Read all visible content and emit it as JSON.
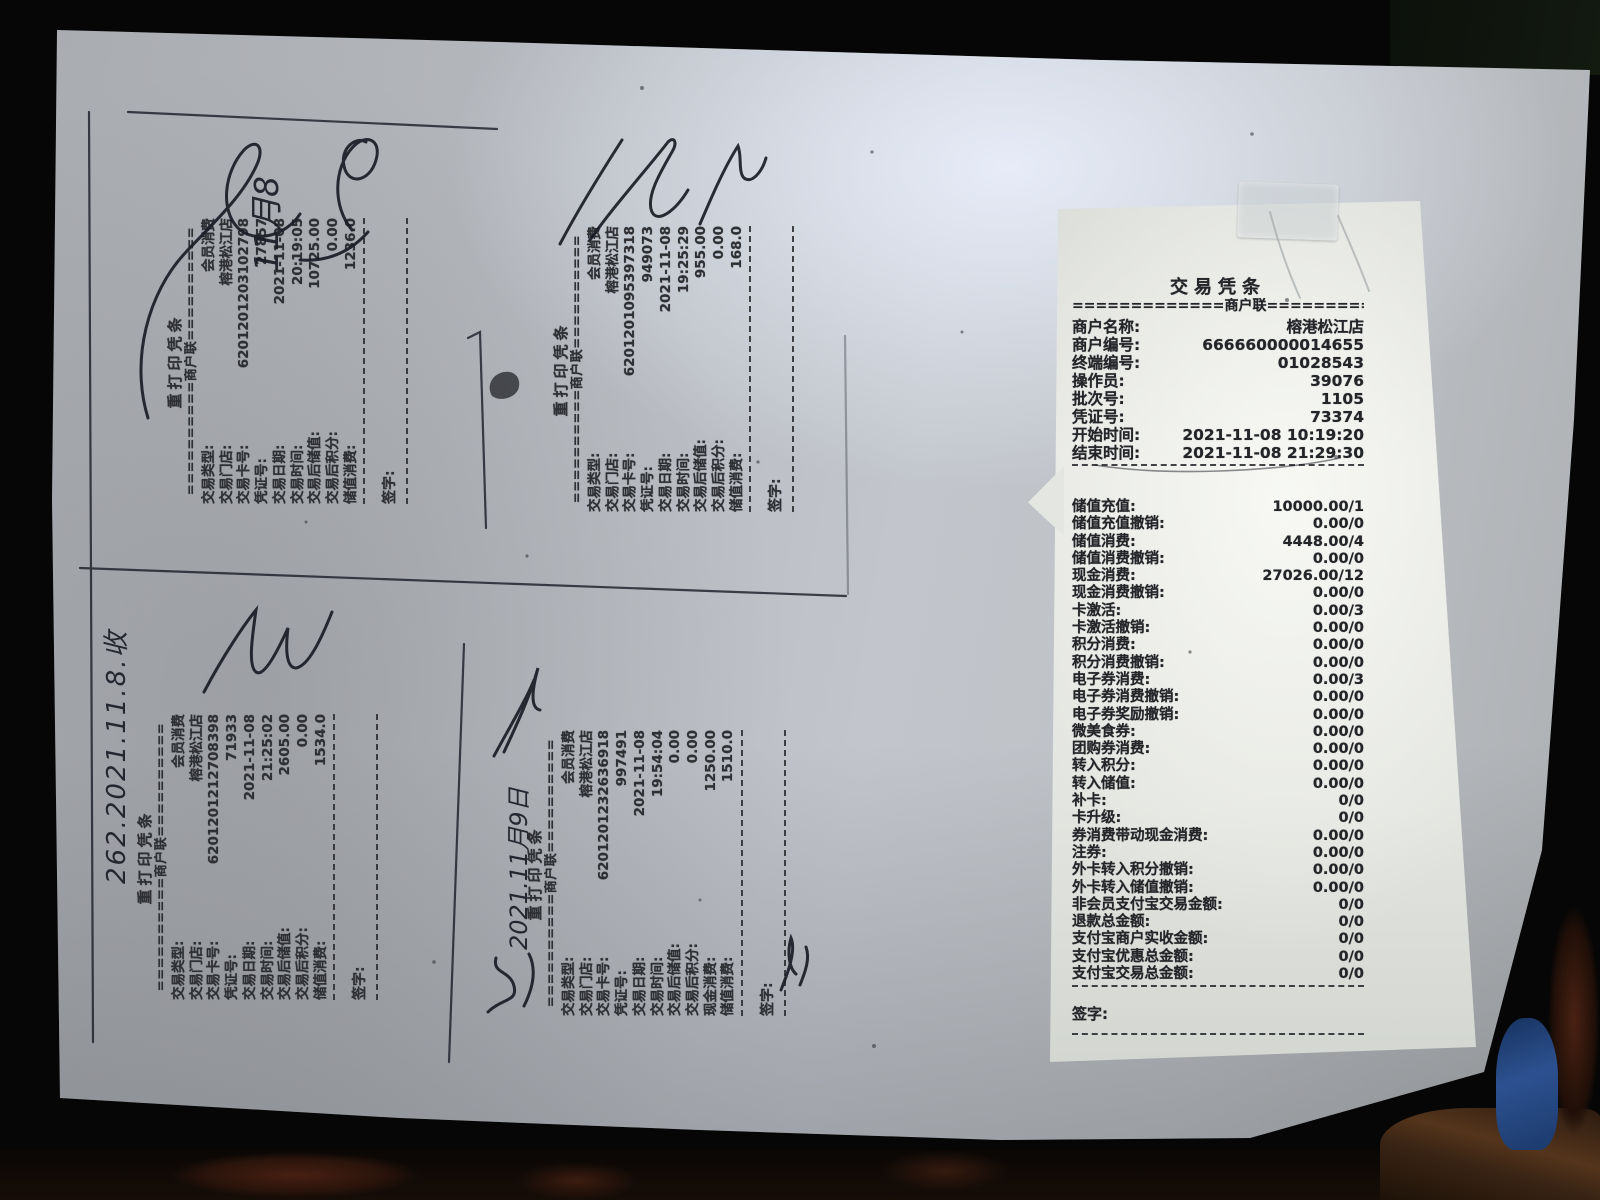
{
  "palette": {
    "background": "#060606",
    "paper": "#b3b6bb",
    "paper_highlight": "#dde2ec",
    "receipt_paper": "#e6e8e4",
    "print_ink": "#2e3034",
    "pen_ink": "#1a1c26",
    "tape": "#cacfd2",
    "blue_object": "#2d5190",
    "table_brown": "#3a2414"
  },
  "reprint_slips": [
    {
      "title": "重打印凭条",
      "copy_line": "==========商户联==========",
      "rows": [
        {
          "label": "交易类型:",
          "value": "会员消费"
        },
        {
          "label": "交易门店:",
          "value": "榕港松江店"
        },
        {
          "label": "交易卡号:",
          "value": "6201201203102798"
        },
        {
          "label": "凭证号:",
          "value": "27857"
        },
        {
          "label": "交易日期:",
          "value": "2021-11-08"
        },
        {
          "label": "交易时间:",
          "value": "20:19:05"
        },
        {
          "label": "交易后储值:",
          "value": "10725.00"
        },
        {
          "label": "交易后积分:",
          "value": "0.00"
        },
        {
          "label": "储值消费:",
          "value": "1236.0"
        }
      ],
      "sign_label": "签字:"
    },
    {
      "title": "重打印凭条",
      "copy_line": "==========商户联==========",
      "rows": [
        {
          "label": "交易类型:",
          "value": "会员消费"
        },
        {
          "label": "交易门店:",
          "value": "榕港松江店"
        },
        {
          "label": "交易卡号:",
          "value": "6201201095397318"
        },
        {
          "label": "凭证号:",
          "value": "949073"
        },
        {
          "label": "交易日期:",
          "value": "2021-11-08"
        },
        {
          "label": "交易时间:",
          "value": "19:25:29"
        },
        {
          "label": "交易后储值:",
          "value": "955.00"
        },
        {
          "label": "交易后积分:",
          "value": "0.00"
        },
        {
          "label": "储值消费:",
          "value": "168.0"
        }
      ],
      "sign_label": "签字:"
    },
    {
      "title": "重打印凭条",
      "copy_line": "==========商户联==========",
      "rows": [
        {
          "label": "交易类型:",
          "value": "会员消费"
        },
        {
          "label": "交易门店:",
          "value": "榕港松江店"
        },
        {
          "label": "交易卡号:",
          "value": "6201201212708398"
        },
        {
          "label": "凭证号:",
          "value": "71933"
        },
        {
          "label": "交易日期:",
          "value": "2021-11-08"
        },
        {
          "label": "交易时间:",
          "value": "21:25:02"
        },
        {
          "label": "交易后储值:",
          "value": "2605.00"
        },
        {
          "label": "交易后积分:",
          "value": "0.00"
        },
        {
          "label": "储值消费:",
          "value": "1534.0"
        }
      ],
      "sign_label": "签字:"
    },
    {
      "title": "重打印凭条",
      "copy_line": "==========商户联==========",
      "rows": [
        {
          "label": "交易类型:",
          "value": "会员消费"
        },
        {
          "label": "交易门店:",
          "value": "榕港松江店"
        },
        {
          "label": "交易卡号:",
          "value": "6201201232636918"
        },
        {
          "label": "凭证号:",
          "value": "997491"
        },
        {
          "label": "交易日期:",
          "value": "2021-11-08"
        },
        {
          "label": "交易时间:",
          "value": "19:54:04"
        },
        {
          "label": "交易后储值:",
          "value": "0.00"
        },
        {
          "label": "交易后积分:",
          "value": "0.00"
        },
        {
          "label": "现金消费:",
          "value": "1250.00"
        },
        {
          "label": "储值消费:",
          "value": "1510.0"
        }
      ],
      "sign_label": "签字:"
    }
  ],
  "summary_slip": {
    "title": "交易凭条",
    "copy_line": "=============商户联=============",
    "header_rows": [
      {
        "label": "商户名称:",
        "value": "榕港松江店"
      },
      {
        "label": "商户编号:",
        "value": "666660000014655"
      },
      {
        "label": "终端编号:",
        "value": "01028543"
      },
      {
        "label": "操作员:",
        "value": "39076"
      },
      {
        "label": "批次号:",
        "value": "1105"
      },
      {
        "label": "凭证号:",
        "value": "73374"
      },
      {
        "label": "开始时间:",
        "value": "2021-11-08  10:19:20"
      },
      {
        "label": "结束时间:",
        "value": "2021-11-08  21:29:30"
      }
    ],
    "totals_rows": [
      {
        "label": "储值充值:",
        "value": "10000.00/1"
      },
      {
        "label": "储值充值撤销:",
        "value": "0.00/0"
      },
      {
        "label": "储值消费:",
        "value": "4448.00/4"
      },
      {
        "label": "储值消费撤销:",
        "value": "0.00/0"
      },
      {
        "label": "现金消费:",
        "value": "27026.00/12"
      },
      {
        "label": "现金消费撤销:",
        "value": "0.00/0"
      },
      {
        "label": "卡激活:",
        "value": "0.00/3"
      },
      {
        "label": "卡激活撤销:",
        "value": "0.00/0"
      },
      {
        "label": "积分消费:",
        "value": "0.00/0"
      },
      {
        "label": "积分消费撤销:",
        "value": "0.00/0"
      },
      {
        "label": "电子券消费:",
        "value": "0.00/3"
      },
      {
        "label": "电子券消费撤销:",
        "value": "0.00/0"
      },
      {
        "label": "电子券奖励撤销:",
        "value": "0.00/0"
      },
      {
        "label": "微美食券:",
        "value": "0.00/0"
      },
      {
        "label": "团购券消费:",
        "value": "0.00/0"
      },
      {
        "label": "转入积分:",
        "value": "0.00/0"
      },
      {
        "label": "转入储值:",
        "value": "0.00/0"
      },
      {
        "label": "补卡:",
        "value": "0/0"
      },
      {
        "label": "卡升级:",
        "value": "0/0"
      },
      {
        "label": "券消费带动现金消费:",
        "value": "0.00/0"
      },
      {
        "label": "注券:",
        "value": "0.00/0"
      },
      {
        "label": "外卡转入积分撤销:",
        "value": "0.00/0"
      },
      {
        "label": "外卡转入储值撤销:",
        "value": "0.00/0"
      },
      {
        "label": "非会员支付宝交易金额:",
        "value": "0/0"
      },
      {
        "label": "退款总金额:",
        "value": "0/0"
      },
      {
        "label": "支付宝商户实收金额:",
        "value": "0/0"
      },
      {
        "label": "支付宝优惠总金额:",
        "value": "0/0"
      },
      {
        "label": "支付宝交易总金额:",
        "value": "0/0"
      }
    ],
    "sign_label": "签字:"
  },
  "annotations": {
    "note_top": "11月8",
    "note_bottom_left": "262.2021.11.8.收",
    "note_bottom_mid": "2021.11月9日"
  }
}
